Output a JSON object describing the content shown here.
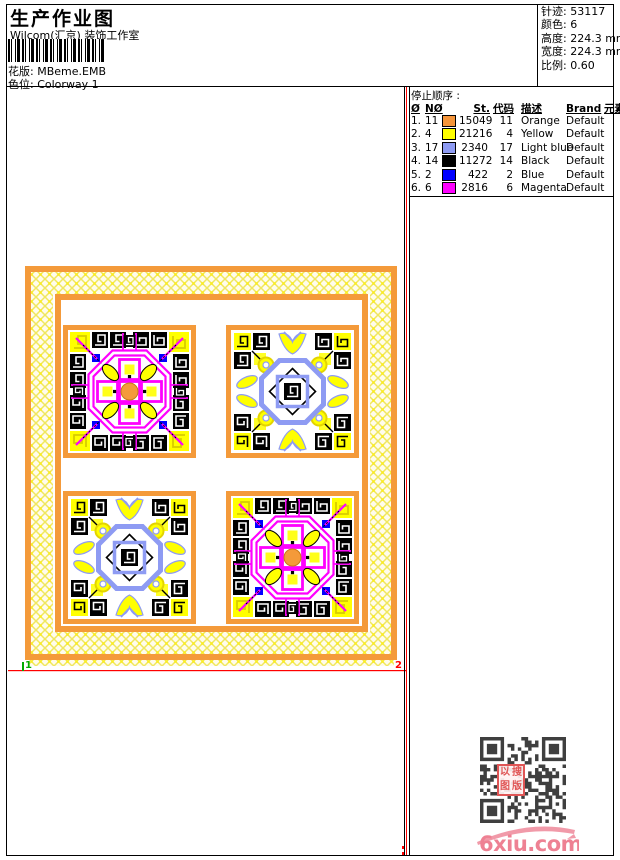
{
  "page": {
    "title": "生产作业图",
    "studio": "Wilcom(汇京) 装饰工作室"
  },
  "design_info": {
    "pattern_label": "花版:",
    "pattern_value": "MBeme.EMB",
    "colorway_label": "色位:",
    "colorway_value": "Colorway 1"
  },
  "stats": [
    {
      "label": "针迹:",
      "value": "53117"
    },
    {
      "label": "颜色:",
      "value": "6"
    },
    {
      "label": "高度:",
      "value": "224.3 mm"
    },
    {
      "label": "宽度:",
      "value": "224.3 mm"
    },
    {
      "label": "比例:",
      "value": "0.60"
    }
  ],
  "stop_sequence": {
    "title": "停止顺序 :",
    "columns": [
      "Ø",
      "NØ",
      "St.",
      "代码",
      "描述",
      "Brand",
      "元素"
    ],
    "rows": [
      {
        "seq": "1.",
        "needle": "11",
        "color": "#F5953A",
        "stitches": "15049",
        "code": "11",
        "description": "Orange",
        "brand": "Default",
        "element": ""
      },
      {
        "seq": "2.",
        "needle": "4",
        "color": "#FFFF00",
        "stitches": "21216",
        "code": "4",
        "description": "Yellow",
        "brand": "Default",
        "element": ""
      },
      {
        "seq": "3.",
        "needle": "17",
        "color": "#8E9BF3",
        "stitches": "2340",
        "code": "17",
        "description": "Light blue",
        "brand": "Default",
        "element": ""
      },
      {
        "seq": "4.",
        "needle": "14",
        "color": "#000000",
        "stitches": "11272",
        "code": "14",
        "description": "Black",
        "brand": "Default",
        "element": ""
      },
      {
        "seq": "5.",
        "needle": "2",
        "color": "#0000FF",
        "stitches": "422",
        "code": "2",
        "description": "Blue",
        "brand": "Default",
        "element": ""
      },
      {
        "seq": "6.",
        "needle": "6",
        "color": "#FF00FF",
        "stitches": "2816",
        "code": "6",
        "description": "Magenta",
        "brand": "Default",
        "element": ""
      }
    ]
  },
  "design": {
    "marker_start": "1",
    "marker_end": "2"
  },
  "watermark": {
    "logo_text": "6xiu.com",
    "stamp_chars": [
      "以",
      "搜",
      "图",
      "版"
    ]
  },
  "colors": {
    "orange": "#F49A3A",
    "yellow": "#FFFF00",
    "light_blue": "#8E9BF3",
    "black": "#000000",
    "blue": "#0000FF",
    "magenta": "#FF00FF",
    "frame_red": "#FF0000",
    "marker_green": "#00AA00",
    "logo_pink": "#EE8193",
    "stamp_red": "#E05555",
    "qr_dark": "#3F3F3F"
  }
}
